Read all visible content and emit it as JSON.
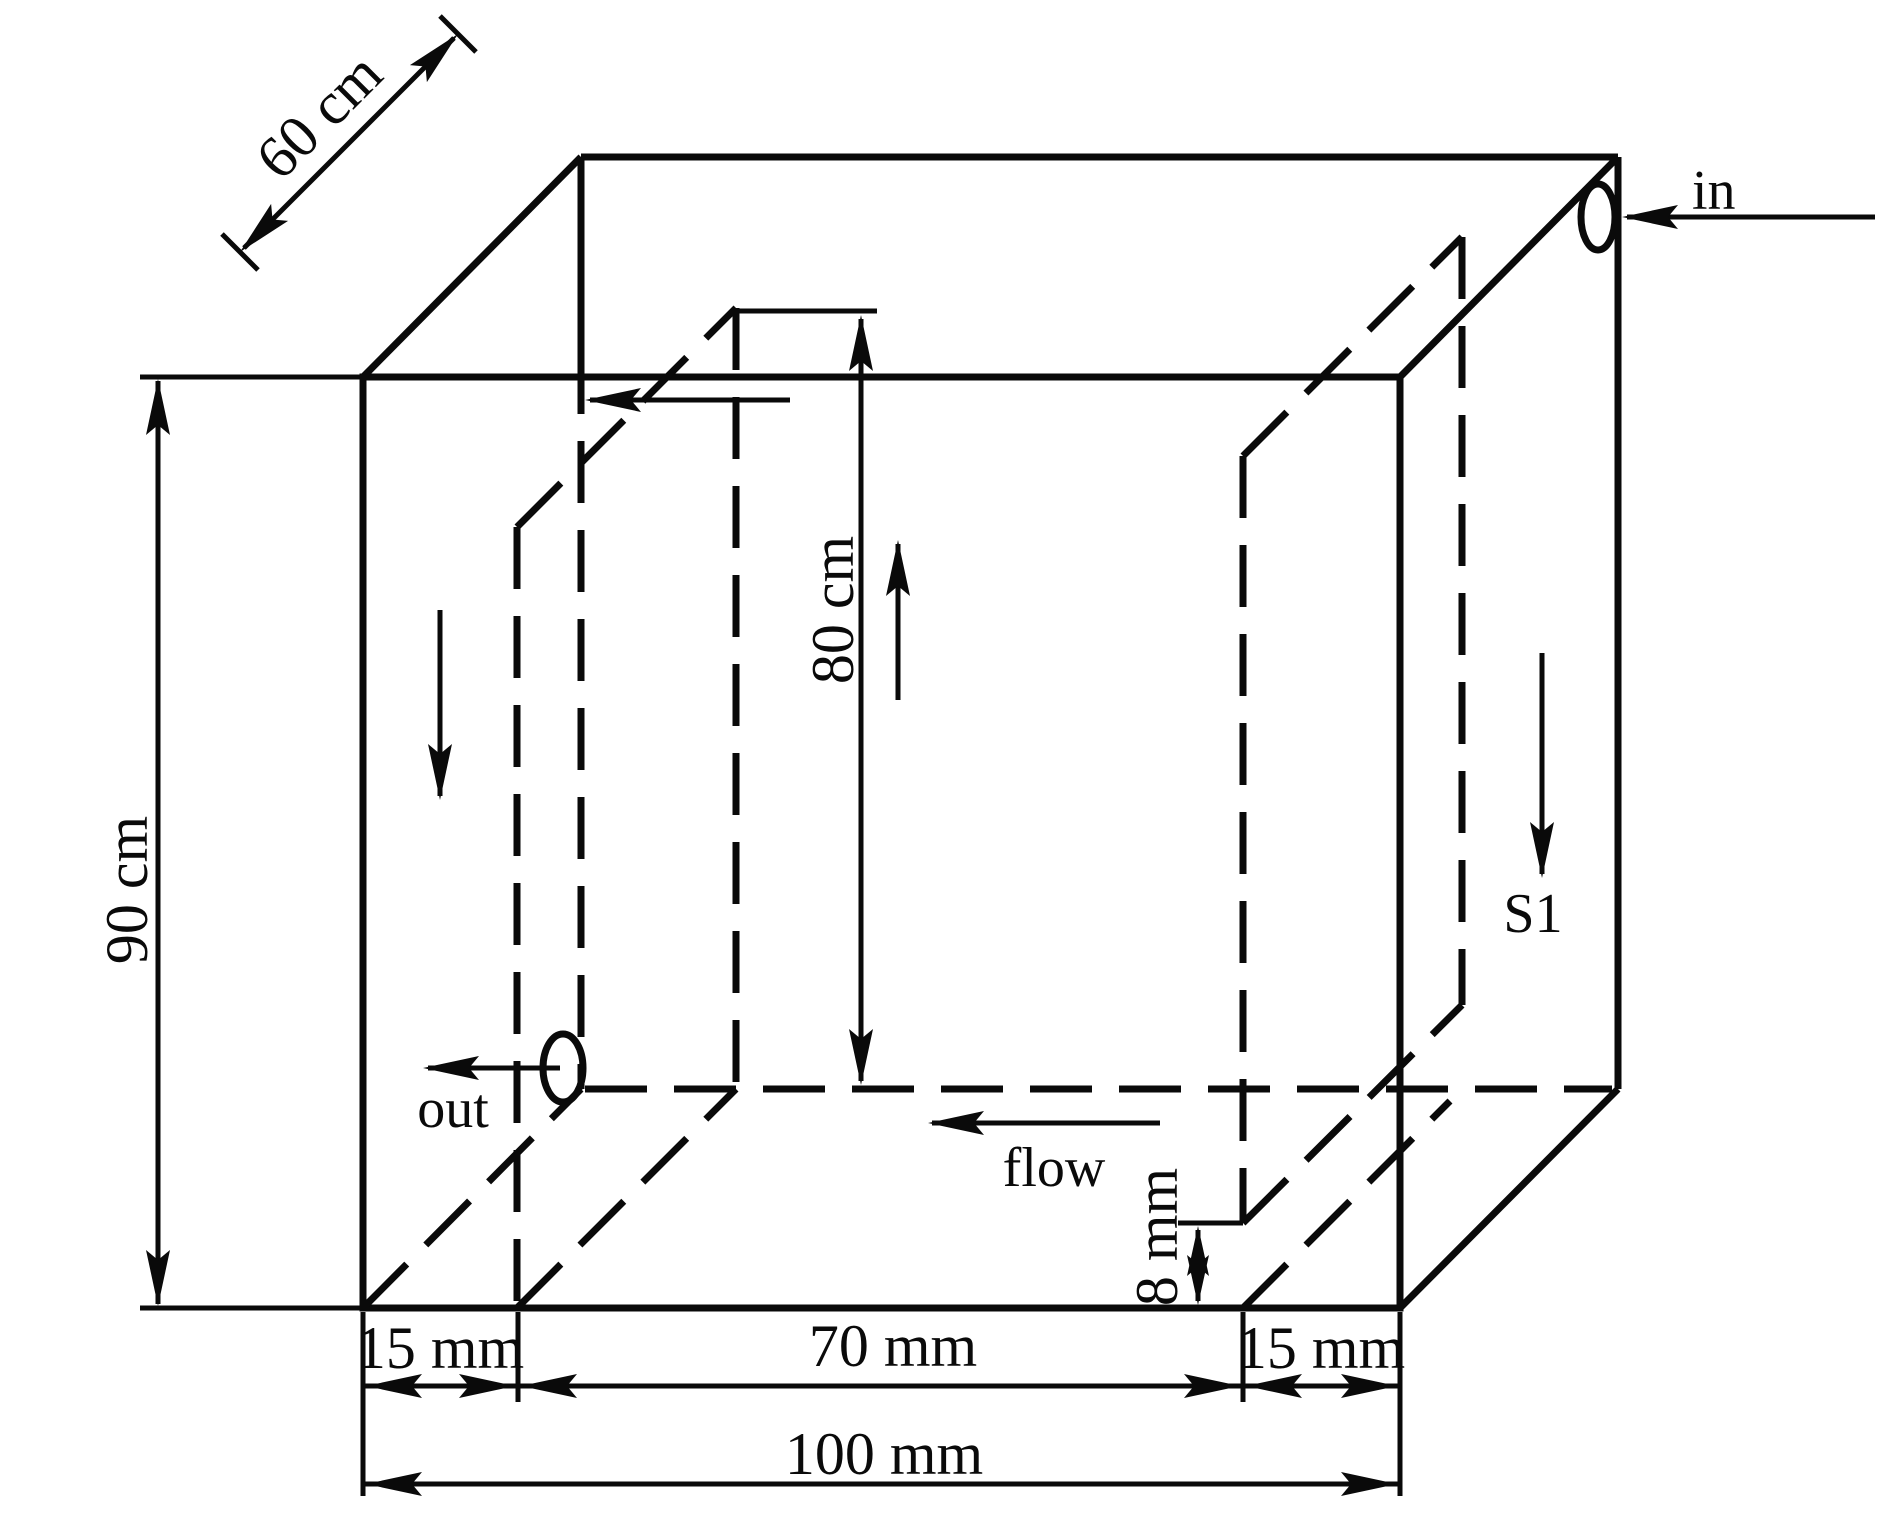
{
  "diagram": {
    "description": "Isometric wireframe drawing of a baffled tank with inlet and outlet ports, internal flow path and dimensions",
    "labels": {
      "height": "90 cm",
      "depth": "60 cm",
      "baffle_height": "80 cm",
      "total_width": "100 mm",
      "left_offset": "15 mm",
      "baffle_spacing": "70 mm",
      "right_offset": "15 mm",
      "bottom_gap": "8 mm",
      "inlet": "in",
      "outlet": "out",
      "flow": "flow",
      "section": "S1"
    },
    "dimensions": {
      "tank_height": {
        "value": 90,
        "unit": "cm"
      },
      "tank_depth": {
        "value": 60,
        "unit": "cm"
      },
      "tank_width": {
        "value": 100,
        "unit": "mm"
      },
      "left_baffle_height": {
        "value": 80,
        "unit": "cm"
      },
      "left_baffle_offset_from_left_wall": {
        "value": 15,
        "unit": "mm"
      },
      "spacing_between_baffles": {
        "value": 70,
        "unit": "mm"
      },
      "right_baffle_offset_from_right_wall": {
        "value": 15,
        "unit": "mm"
      },
      "right_baffle_bottom_gap": {
        "value": 8,
        "unit": "mm"
      }
    },
    "colors": {
      "line": "#0a0a0a",
      "background": "#ffffff"
    }
  }
}
